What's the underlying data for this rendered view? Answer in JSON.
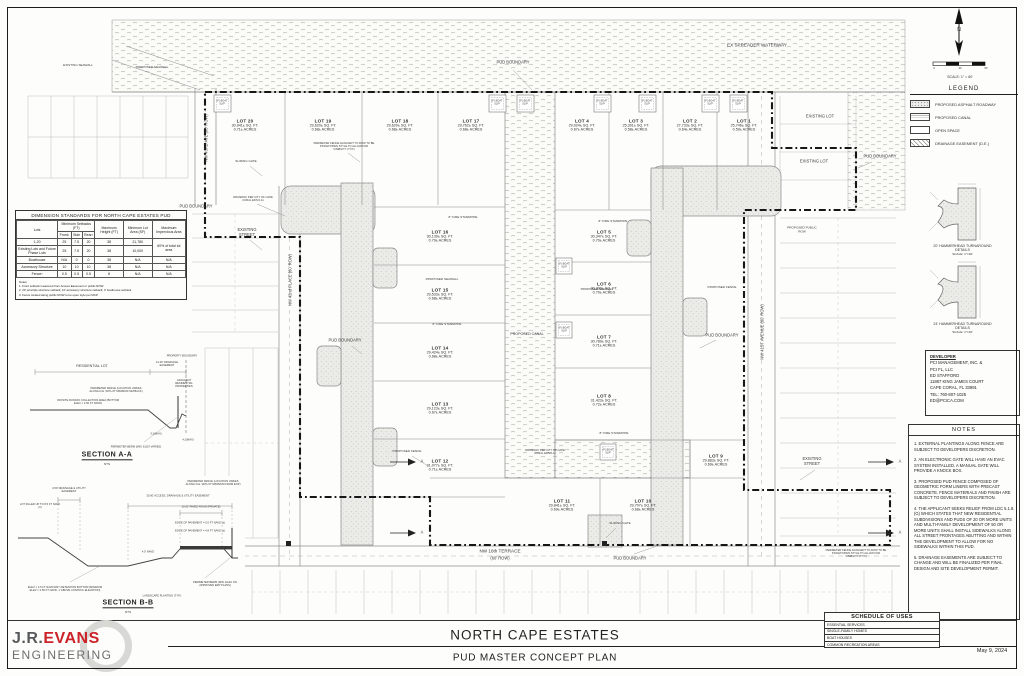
{
  "sheet": {
    "title": "NORTH CAPE ESTATES",
    "subtitle": "PUD MASTER CONCEPT PLAN",
    "date": "May 9, 2024",
    "logo": {
      "jr": "J.R.",
      "evans": "EVANS",
      "engineering": "ENGINEERING"
    }
  },
  "compass": {
    "n": "N",
    "scale_label": "SCALE: 1\" = 60'",
    "ticks": [
      "0",
      "30",
      "60"
    ]
  },
  "legend": {
    "title": "LEGEND",
    "items": [
      {
        "label": "PROPOSED ASPHALT ROADWAY",
        "swatch": "stipple-swatch"
      },
      {
        "label": "PROPOSED CANAL",
        "swatch": "wave-swatch"
      },
      {
        "label": "OPEN SPACE",
        "swatch": "plain-swatch"
      },
      {
        "label": "DRAINAGE EASEMENT (D.E.)",
        "swatch": "hatch-swatch"
      }
    ]
  },
  "turnarounds": [
    {
      "line1": "20' HAMMERHEAD TURNAROUND",
      "line2": "DETAILS",
      "scale": "SCALE: 1\"=40'"
    },
    {
      "line1": "24' HAMMERHEAD TURNAROUND",
      "line2": "DETAILS",
      "scale": "SCALE: 1\"=40'"
    }
  ],
  "developer": {
    "heading": "DEVELOPER",
    "lines": [
      "PCI MANAGEMENT, INC. &",
      "PCI FL, LLC",
      "ED STAFFORD",
      "11887 KING JAMES COURT",
      "CAPE CORAL, FL 33991",
      "TEL: 760-807-1025",
      "ED@PCICA.COM"
    ]
  },
  "notes": {
    "title": "NOTES",
    "items": [
      "1. EXTERNAL PLANTINGS ALONG FENCE ARE SUBJECT TO DEVELOPERS DISCRETION.",
      "2. AN ELECTRONIC GATE WILL HAVE AN EVAC SYSTEM INSTALLED. A MANUAL GATE WILL PROVIDE A KNOCK BOX.",
      "3. PROPOSED PUD FENCE COMPOSED OF GEOMETRIC FORM LINERS WITH PRECAST CONCRETE. FENCE MATERIALS AND FINISH ARE SUBJECT TO DEVELOPERS DISCRETION.",
      "4. THE APPLICANT SEEKS RELIEF FROM LDC 5.1.8. (G) WHICH STATES THAT NEW RESIDENTIAL SUBDIVISIONS AND PUDS OF 20 OR MORE UNITS AND MULTI-FAMILY DEVELOPMENT OF 50 OR MORE UNITS SHALL INSTALL SIDEWALKS ALONG ALL STREET FRONTAGES ABUTTING AND WITHIN THE DEVELOPMENT TO ALLOW FOR NO SIDEWALKS WITHIN THIS PUD.",
      "5. DRAINAGE EASEMENTS ARE SUBJECT TO CHANGE AND WILL BE FINALIZED PER FINAL DESIGN AND SITE DEVELOPMENT PERMIT."
    ]
  },
  "schedule": {
    "title": "SCHEDULE OF USES",
    "rows": [
      "ESSENTIAL SERVICES",
      "SINGLE-FAMILY HOMES",
      "BOAT HOUSES",
      "COMMON RECREATION AREAS"
    ]
  },
  "dimension_table": {
    "title": "DIMENSION STANDARDS FOR NORTH CAPE ESTATES PUD",
    "h_lots": "Lots",
    "h_setbacks": "Minimum Setbacks (FT)",
    "h_front": "Front¹",
    "h_side": "Side",
    "h_rear": "Rear²",
    "h_height": "Maximum Height (FT)",
    "h_area": "Minimum Lot Area (SF)",
    "h_imperv": "Maximum Impervious Area",
    "rows": [
      {
        "lots": "1-20",
        "front": "25",
        "side": "7.5",
        "rear": "20",
        "height": "38",
        "area": "21,780",
        "imperv": "60% of total lot area"
      },
      {
        "lots": "Existing Lots and Future Phase Lots",
        "front": "25",
        "side": "7.5",
        "rear": "20",
        "height": "38",
        "area": "10,000"
      },
      {
        "lots": "Boathouse",
        "front": "N/A",
        "side": "0",
        "rear": "0",
        "height": "38",
        "area": "N/A",
        "imperv": "N/A"
      },
      {
        "lots": "Accessory Structure",
        "front": "10",
        "side": "10",
        "rear": "10",
        "height": "38",
        "area": "N/A",
        "imperv": "N/A"
      },
      {
        "lots": "Fence³",
        "front": "0.5",
        "side": "0.5",
        "rear": "0.5",
        "height": "8",
        "area": "N/A",
        "imperv": "N/A"
      }
    ],
    "notes_title": "Notes:",
    "notes": [
      "1. Front setback measured from Access Easement or public ROW.",
      "2. 20' principle structure setback; 10' accessory structure setback; 0' boathouse setback.",
      "3. Fence located along public ROW to be open style per MCP."
    ]
  },
  "section_a": {
    "title": "SECTION A-A",
    "scale": "NTS",
    "labels": {
      "residential_lot": "RESIDENTIAL LOT",
      "drainage_easement": "12.00' DRAINAGE EASEMENT",
      "property_boundary": "PROPERTY BOUNDARY",
      "perimeter_fence": "PERIMETER FENCE (LOCATION VARIES ALONG D.E. WITH 8\" MINIMUM SETBACK)",
      "offsite_runoff": "OFFSITE RUNOFF COLLECTION AREA (BOTTOM ELEV = 2.50 FT NAVD)",
      "adjacent": "ADJACENT RESIDENTIAL PROPERTIES",
      "berm": "PERIMETER BERM (MIN. ELEV VARIES)",
      "slope1": "3:1(MAX)",
      "slope2": "4:1(MAX)"
    }
  },
  "section_b": {
    "title": "SECTION B-B",
    "scale": "NTS",
    "labels": {
      "lot_filled": "LOT FILLED UP TO 8.5 FT NAVD (±)",
      "drainage_utility": "4.50' DRAINAGE & UTILITY EASEMENT",
      "access_easement": "30.00' ACCESS, DRAINAGE & UTILITY EASEMENT",
      "paved_road": "20.00' PAVED ROAD (PRIVATE)",
      "perimeter_fence": "PERIMETER FENCE (LOCATION VARIES ALONG D.E. WITH 8\" MINIMUM FROM EOP)",
      "eop1": "EDGE OF PAVEMENT = 5.0 FT NAVD (±)",
      "eop2": "EDGE OF PAVEMENT = 4.8 FT NAVD (±)",
      "navd": "4.5' NAVD",
      "detention": "ELEV = 2.5 FT NAVD DRY DETENTION BOTTOM (MINIMUM ELEV = 2.50 FT NAVD, 1' ABOVE CONTROL ELEVATION)",
      "landscape": "LANDSCAPE PLANTING (TYP.)",
      "berm": "PERIMETER BERM (MIN. ELEV ON APPROVED ERP PLANS)"
    }
  },
  "plan": {
    "waterway_label": "EX SPREADER WATERWAY",
    "canal_label": "PROPOSED CANAL",
    "boat_slip": "(F) BOAT SLIP",
    "pud_boundary": "PUD BOUNDARY",
    "existing_street": "EXISTING STREET",
    "existing_lot": "EXISTING LOT",
    "streets": {
      "nw43": "NW 43RD AVE (60' ROW)",
      "nw42": "NW 42nd PLACE (60' ROW)",
      "nw41": "NW 41ST AVENUE (60' ROW)",
      "nw16_l1": "NW 16th TERRACE",
      "nw16_l2": "(60' ROW)"
    },
    "annotations": {
      "proposed_seawall": "PROPOSED SEAWALL",
      "existing_seawall": "EXISTING SEAWALL",
      "fire_standpipe": "8\" FIRE STANDPIPE",
      "sliding_gate": "SLIDING GATE",
      "perimeter_fence_row": "PERIMETER FENCE ADJACENT TO ROW TO BE PICKET/OPEN STYLE TO ALLOW FOR VISIBILITY (TYP.)",
      "driveway": "DRIVEWAY PER CITY OF CAPE CORAL EDS-5-11",
      "proposed_fence": "PROPOSED FENCE",
      "proposed_public_row": "PROPOSED PUBLIC ROW",
      "marker_a": "A"
    },
    "lots": [
      {
        "name": "LOT 1",
        "sqft": "25,746± SQ. FT.",
        "acres": "0.59± ACRES"
      },
      {
        "name": "LOT 2",
        "sqft": "27,733± SQ. FT.",
        "acres": "0.64± ACRES"
      },
      {
        "name": "LOT 3",
        "sqft": "25,301± SQ. FT.",
        "acres": "0.58± ACRES"
      },
      {
        "name": "LOT 4",
        "sqft": "29,024± SQ. FT.",
        "acres": "0.67± ACRES"
      },
      {
        "name": "LOT 5",
        "sqft": "30,347± SQ. FT.",
        "acres": "0.70± ACRES"
      },
      {
        "name": "LOT 6",
        "sqft": "30,300± SQ. FT.",
        "acres": "0.70± ACRES"
      },
      {
        "name": "LOT 7",
        "sqft": "30,789± SQ. FT.",
        "acres": "0.71± ACRES"
      },
      {
        "name": "LOT 8",
        "sqft": "31,423± SQ. FT.",
        "acres": "0.72± ACRES"
      },
      {
        "name": "LOT 9",
        "sqft": "29,883± SQ. FT.",
        "acres": "0.69± ACRES"
      },
      {
        "name": "LOT 10",
        "sqft": "29,707± SQ. FT.",
        "acres": "0.68± ACRES"
      },
      {
        "name": "LOT 11",
        "sqft": "29,841± SQ. FT.",
        "acres": "0.69± ACRES"
      },
      {
        "name": "LOT 12",
        "sqft": "31,077± SQ. FT.",
        "acres": "0.71± ACRES"
      },
      {
        "name": "LOT 13",
        "sqft": "29,123± SQ. FT.",
        "acres": "0.67± ACRES"
      },
      {
        "name": "LOT 14",
        "sqft": "29,424± SQ. FT.",
        "acres": "0.68± ACRES"
      },
      {
        "name": "LOT 15",
        "sqft": "29,533± SQ. FT.",
        "acres": "0.68± ACRES"
      },
      {
        "name": "LOT 16",
        "sqft": "30,139± SQ. FT.",
        "acres": "0.70± ACRES"
      },
      {
        "name": "LOT 17",
        "sqft": "29,762± SQ. FT.",
        "acres": "0.68± ACRES"
      },
      {
        "name": "LOT 18",
        "sqft": "29,620± SQ. FT.",
        "acres": "0.68± ACRES"
      },
      {
        "name": "LOT 19",
        "sqft": "29,620± SQ. FT.",
        "acres": "0.68± ACRES"
      },
      {
        "name": "LOT 20",
        "sqft": "30,941± SQ. FT.",
        "acres": "0.71± ACRES"
      }
    ]
  }
}
